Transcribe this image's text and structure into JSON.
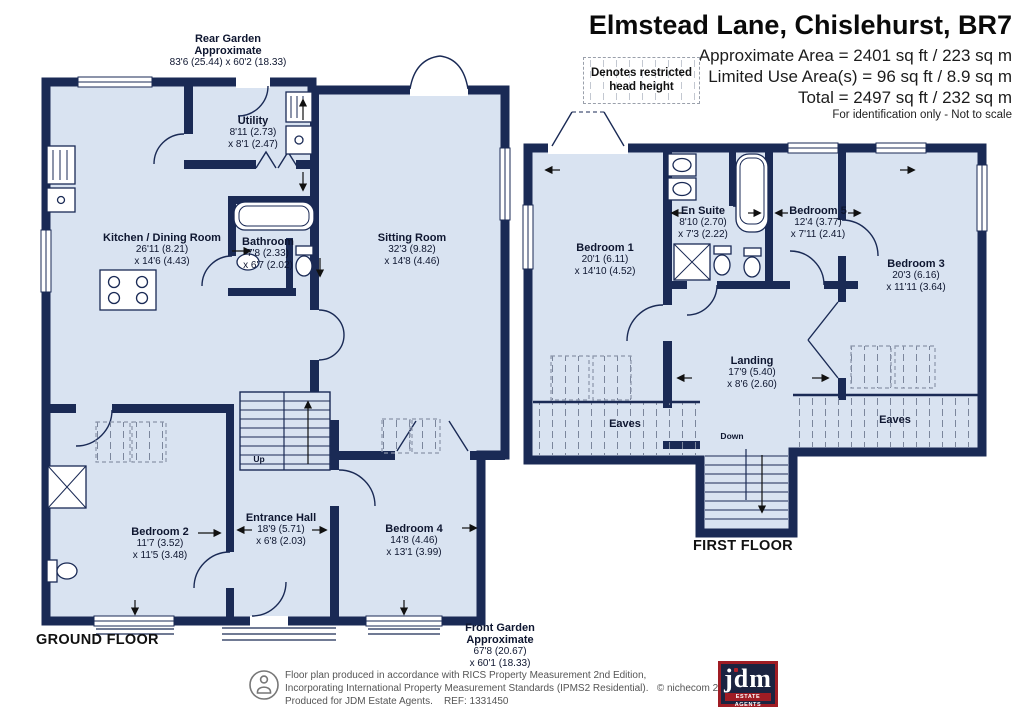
{
  "colors": {
    "wall": "#1a2a55",
    "floor": "#d9e3f1",
    "logo_navy": "#1b2340",
    "logo_red": "#9f1c24"
  },
  "header": {
    "title": "Elmstead Lane, Chislehurst, BR7",
    "area_lines": [
      "Approximate Area = 2401 sq ft / 223 sq m",
      "Limited Use Area(s) = 96 sq ft / 8.9 sq m",
      "Total = 2497 sq ft / 232 sq m"
    ],
    "disclaimer": "For identification only - Not to scale",
    "legend_line1": "Denotes restricted",
    "legend_line2": "head height"
  },
  "ground": {
    "floor_label": "GROUND FLOOR",
    "up_label": "Up",
    "rear_garden": {
      "name": "Rear Garden",
      "sub": "Approximate",
      "dims": "83'6 (25.44) x 60'2 (18.33)"
    },
    "front_garden": {
      "name": "Front Garden",
      "sub": "Approximate",
      "d1": "67'8 (20.67)",
      "d2": "x 60'1 (18.33)"
    },
    "rooms": {
      "utility": {
        "name": "Utility",
        "d1": "8'11 (2.73)",
        "d2": "x 8'1 (2.47)"
      },
      "kitchen": {
        "name": "Kitchen / Dining Room",
        "d1": "26'11 (8.21)",
        "d2": "x 14'6 (4.43)"
      },
      "bathroom": {
        "name": "Bathroom",
        "d1": "7'8 (2.33)",
        "d2": "x 6'7 (2.02)"
      },
      "sitting": {
        "name": "Sitting Room",
        "d1": "32'3 (9.82)",
        "d2": "x 14'8 (4.46)"
      },
      "bedroom2": {
        "name": "Bedroom 2",
        "d1": "11'7 (3.52)",
        "d2": "x 11'5 (3.48)"
      },
      "entrance": {
        "name": "Entrance Hall",
        "d1": "18'9 (5.71)",
        "d2": "x 6'8 (2.03)"
      },
      "bedroom4": {
        "name": "Bedroom 4",
        "d1": "14'8 (4.46)",
        "d2": "x 13'1 (3.99)"
      }
    }
  },
  "first": {
    "floor_label": "FIRST FLOOR",
    "down_label": "Down",
    "eaves_label": "Eaves",
    "rooms": {
      "bedroom1": {
        "name": "Bedroom 1",
        "d1": "20'1 (6.11)",
        "d2": "x 14'10 (4.52)"
      },
      "ensuite": {
        "name": "En Suite",
        "d1": "8'10 (2.70)",
        "d2": "x 7'3 (2.22)"
      },
      "bedroom5": {
        "name": "Bedroom 5",
        "d1": "12'4 (3.77)",
        "d2": "x 7'11 (2.41)"
      },
      "bedroom3": {
        "name": "Bedroom 3",
        "d1": "20'3 (6.16)",
        "d2": "x 11'11 (3.64)"
      },
      "landing": {
        "name": "Landing",
        "d1": "17'9 (5.40)",
        "d2": "x 8'6 (2.60)"
      }
    }
  },
  "footer": {
    "lines": [
      "Floor plan produced in accordance with RICS Property Measurement 2nd Edition,",
      "Incorporating International Property Measurement Standards (IPMS2 Residential).   © nichecom 2025.",
      "Produced for JDM Estate Agents.    REF: 1331450"
    ],
    "logo_text": "jdm",
    "logo_tagline": "ESTATE AGENTS"
  }
}
